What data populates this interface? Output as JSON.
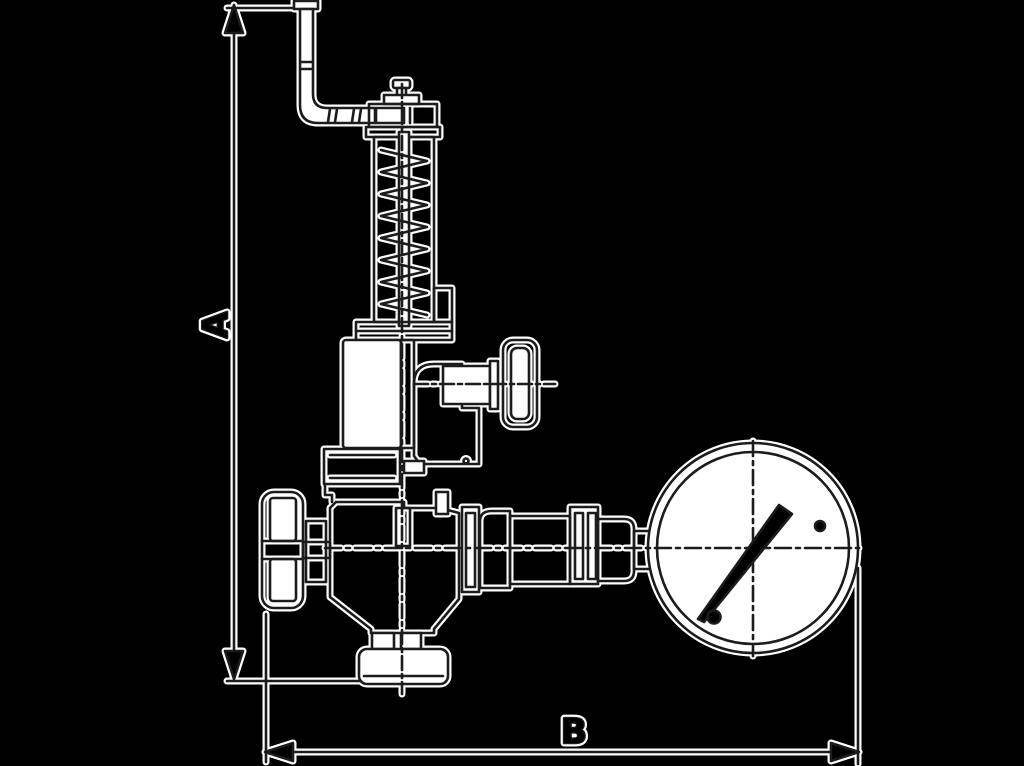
{
  "diagram": {
    "type": "technical-outline-drawing",
    "subject": "safety relief valve with test lever, side test knob, inlet handwheel, bottom outlet flange and pressure gauge",
    "labels": {
      "dim_vertical": "A",
      "dim_horizontal": "B"
    },
    "dimensions": {
      "a": {
        "label": "A",
        "orientation": "vertical",
        "measures": "overall height from lever top to outlet flange bottom"
      },
      "b": {
        "label": "B",
        "orientation": "horizontal",
        "measures": "overall width from handwheel left edge to gauge right edge"
      }
    },
    "colors": {
      "background": "#000000",
      "line_ink": "#1c1c1c",
      "line_halo": "#ffffff",
      "shape_fill": "#ffffff"
    },
    "gauge": {
      "needle_direction": "pointing upper-right",
      "face_marks": [
        "crosshair",
        "two pivot dots"
      ]
    }
  }
}
